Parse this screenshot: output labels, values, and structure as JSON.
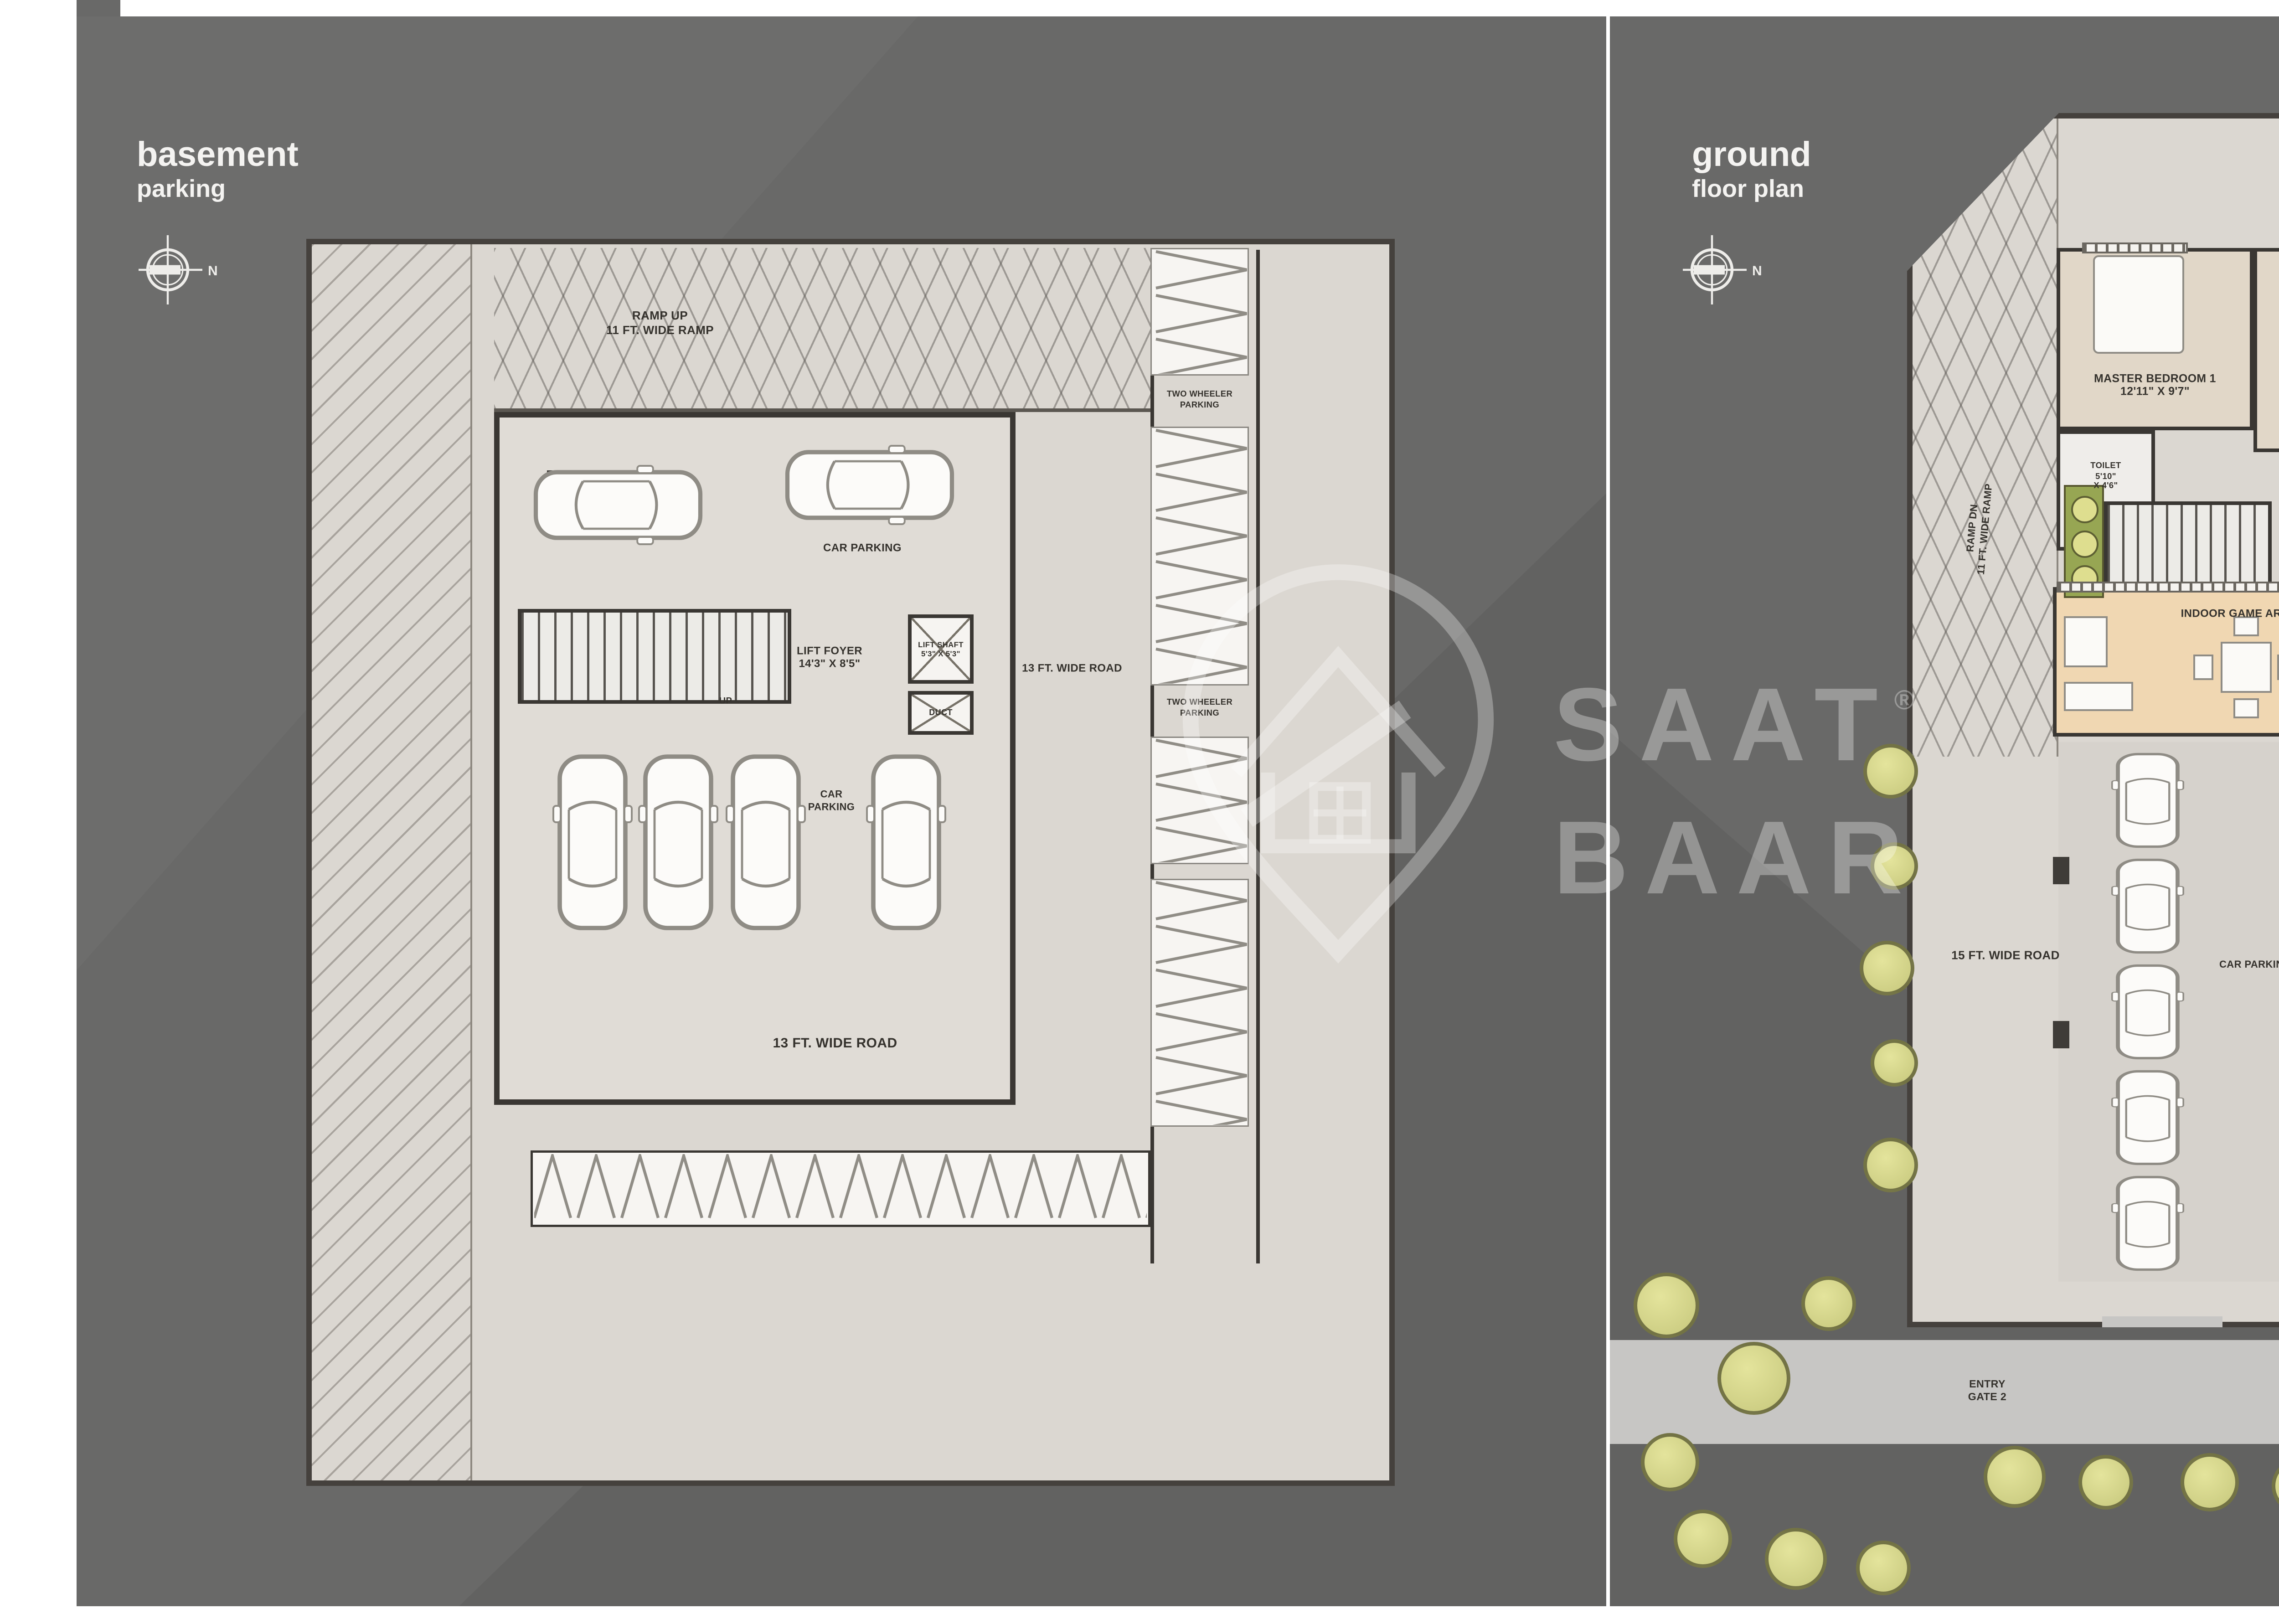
{
  "meta": {
    "colors": {
      "panel_gray": "#696968",
      "plan_paper": "#dbd7d1",
      "wall_dark": "#3a3733",
      "garden_green": "#8d9e4d",
      "road_gray": "#c7c6c4",
      "logo_green": "#1d4f2c",
      "logo_gold": "#ddb874"
    }
  },
  "watermark": {
    "brand_top": "SAAT",
    "brand_bottom": "BAAR",
    "registered": "®"
  },
  "footer": {
    "brand_top": "SAAT",
    "brand_bottom": "BAAR",
    "registered": "®",
    "website": "www.saatbaar.com"
  },
  "basement": {
    "title": "basement",
    "subtitle": "parking",
    "north": "N",
    "ramp": "RAMP UP\n11 FT. WIDE RAMP",
    "car_parking_top": "CAR PARKING",
    "lift_foyer": "LIFT FOYER\n14'3\" X 8'5\"",
    "lift_shaft": "LIFT SHAFT\n5'3\" X 5'3\"",
    "duct": "DUCT",
    "up": "UP",
    "car_parking_mid": "CAR\nPARKING",
    "road_side": "13 FT. WIDE ROAD",
    "road_bottom": "13 FT. WIDE ROAD",
    "two_wheeler_top": "TWO WHEELER\nPARKING",
    "two_wheeler_bottom": "TWO WHEELER\nPARKING"
  },
  "ground": {
    "title": "ground",
    "subtitle": "floor plan",
    "north": "N",
    "ramp": "RAMP DN\n11 FT. WIDE RAMP",
    "master_bedroom_1": "MASTER BEDROOM 1\n12'11\" X 9'7\"",
    "toilet_mb1": "TOILET\n5'10\"\nX 4'6\"",
    "guest_bedroom": "GUEST BEDROOM\n10'0\" X 9'4\"",
    "living_dining": "LIVING AREA + DINING\n22'5\" X 15'8\"",
    "master_bedroom_2": "MASTER BEDROOM 2\n11'0\" X 10'10\"",
    "store": "STORE\n3'11\"\nX 4'6\"",
    "toilet_mb2": "TOILET\n6'8\"\nX 4'6\"",
    "kitchen": "KITCHEN\n10'7\" X 8'5\"",
    "wash": "WASH\n4'2\" X 8'5\"",
    "lift_foyer": "LIFT FOYER\n14'3\" x 8'5\"",
    "lift_shaft": "LIFT SHAFT",
    "toilet_common": "TOILET\n4'5\" X 8'5\"",
    "dn": "DN",
    "indoor_game": "INDOOR GAME AREA",
    "entry_foyer": "ENTRY\nFOYER",
    "back_entry": "BACK ENTRY",
    "security_cabin": "SECURITY CABIN",
    "toilet_security": "TOILET",
    "road_left": "15 FT. WIDE ROAD",
    "road_right": "15 FT. WIDE ROAD",
    "car_parking_left": "CAR PARKING",
    "car_parking_right": "CAR PARKING",
    "entry_gate_2": "ENTRY\nGATE 2",
    "entry_gate_1": "ENTRY\nGATE 1",
    "main_road": "30 FT. WIDE ROAD"
  }
}
